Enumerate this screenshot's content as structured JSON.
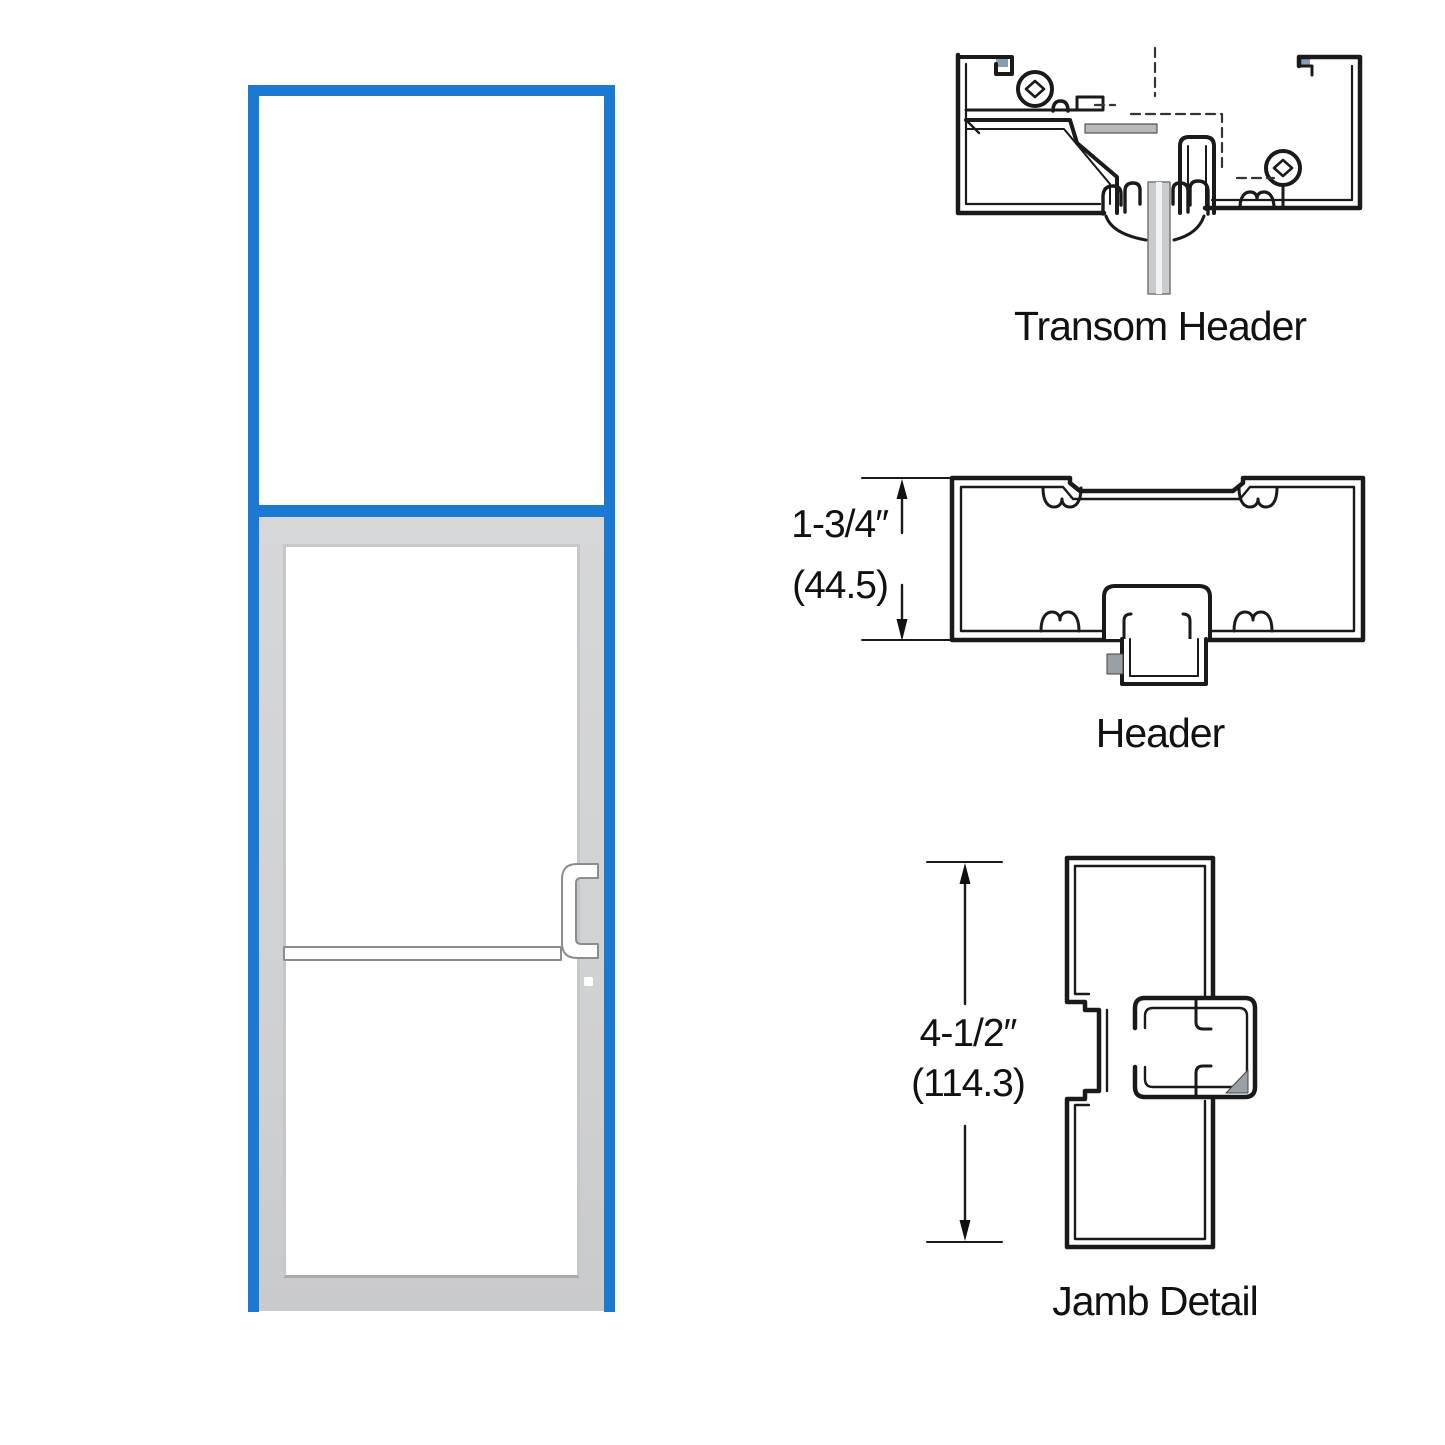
{
  "colors": {
    "frame_blue": "#1b79d2",
    "door_gray_light": "#d6d7d9",
    "door_gray": "#cfd0d2",
    "line": "#1a1a1a",
    "metal_gray": "#9aa0a4",
    "glass_edge_gray": "#c6c7c9"
  },
  "sections": {
    "transom_header": {
      "label": "Transom Header"
    },
    "header": {
      "label": "Header",
      "dim_imperial": "1-3/4″",
      "dim_metric": "(44.5)"
    },
    "jamb": {
      "label": "Jamb Detail",
      "dim_imperial": "4-1/2″",
      "dim_metric": "(114.3)"
    }
  }
}
